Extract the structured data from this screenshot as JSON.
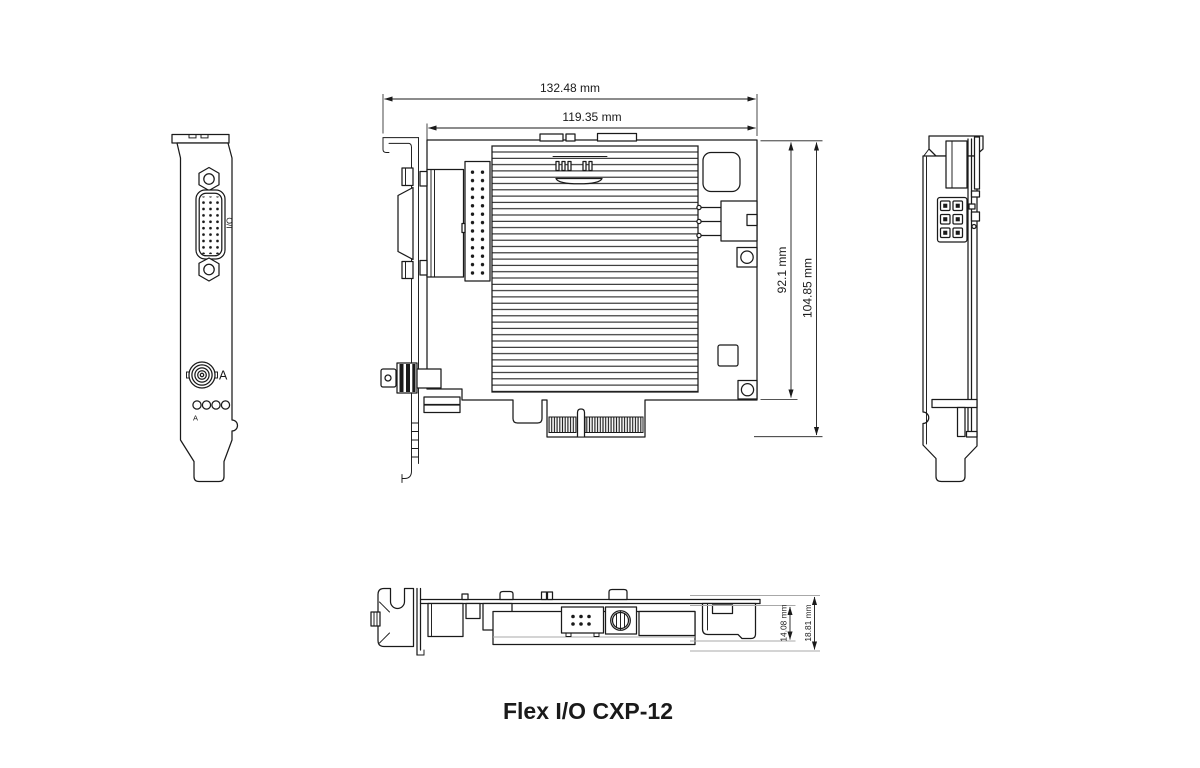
{
  "title": "Flex I/O CXP-12",
  "top_view": {
    "dim_overall_width": "132.48 mm",
    "dim_pcb_width": "119.35 mm",
    "dim_pcb_height": "92.1 mm",
    "dim_overall_height": "104.85 mm"
  },
  "front_view": {
    "io_connector_label": "I/O",
    "coax_connector_label": "A",
    "led_group_label": "A"
  },
  "profile_view": {
    "dim_component_height": "14.08 mm",
    "dim_overall_height": "18.81 mm"
  },
  "colors": {
    "line": "#1a1a1a",
    "extension_line": "#a8a8a8",
    "background": "#ffffff"
  }
}
